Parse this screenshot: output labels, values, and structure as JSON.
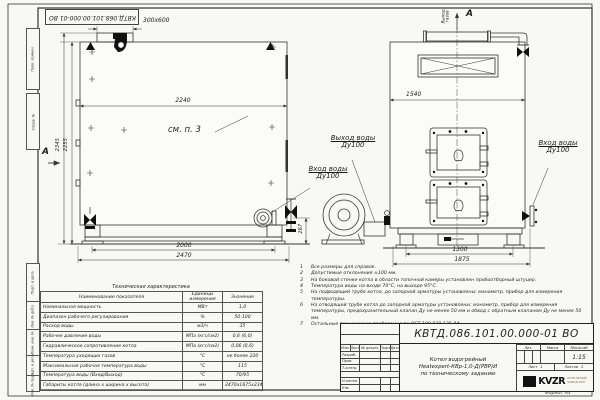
{
  "frame": {
    "stamp_top": "КВТД.068.101.00.000-01 ВО",
    "side_labels": [
      "Перв. примен.",
      "Справ. №",
      "Подп. и дата",
      "Инв. № дубл.",
      "Взам. инв. №",
      "Подп. и дата",
      "Инв. № подл."
    ],
    "format_note": "Формат А3"
  },
  "dims": {
    "duct": "300x600",
    "side_width": "2240",
    "side_height_total": "2345",
    "side_height_body": "2255",
    "side_base_inner": "2000",
    "side_base_outer": "2470",
    "inlet_height": "267",
    "front_width": "1540",
    "front_base_inner": "1300",
    "front_base_outer": "1875"
  },
  "labels": {
    "see_note": "см. п. 3",
    "view_arrow_left": "А",
    "view_arrow_top": "А",
    "water_out_line1": "Выход воды",
    "water_out_line2": "Ду100",
    "water_in_line1": "Вход воды",
    "water_in_line2": "Ду100",
    "gas_out_line1": "Выход",
    "gas_out_line2": "газов",
    "water_in_right_line1": "Вход воды",
    "water_in_right_line2": "Ду100"
  },
  "notes": [
    {
      "n": "1",
      "t": "Все размеры для справок."
    },
    {
      "n": "2",
      "t": "Допустимые отклонения ±100 мм."
    },
    {
      "n": "3",
      "t": "На боковой стенке котла в области топочной камеры установлен пробоотборный штуцер."
    },
    {
      "n": "4",
      "t": "Температура воды на входе 70°С, на выходе 95°С."
    },
    {
      "n": "5",
      "t": "На подводящей трубе котла, до запорной арматуры установлены: манометр, прибор для измерения температуры."
    },
    {
      "n": "6",
      "t": "На отводящей трубе котла до запорной арматуры установлены: манометр, прибор для измерения температуры, предохранительный клапан Ду не менее 50 мм и обвод с обратным клапаном Ду не менее 50 мм."
    },
    {
      "n": "7",
      "t": "Остальные технические требования по ОСТ 108.030.135-84."
    }
  ],
  "tech_table": {
    "title": "Техническая характеристика",
    "headers": [
      "Наименование показателя",
      "Единицы измерения",
      "Значение"
    ],
    "rows": [
      [
        "Номинальная мощность",
        "МВт",
        "1,0"
      ],
      [
        "Диапазон рабочего регулирования",
        "%",
        "50-100"
      ],
      [
        "Расход воды",
        "м3/ч",
        "35"
      ],
      [
        "Рабочее давление воды",
        "МПа (кгс/см2)",
        "0,6 (6,0)"
      ],
      [
        "Гидравлическое сопротивление котла",
        "МПа (кгс/см2)",
        "0,06 (0,6)"
      ],
      [
        "Температура уходящих газов",
        "°С",
        "не более 220"
      ],
      [
        "Максимальная рабочая температура воды",
        "°С",
        "115"
      ],
      [
        "Температура воды (Вход/Выход)",
        "°С",
        "70/95"
      ],
      [
        "Габариты котла (длина х ширина х высота)",
        "мм",
        "2470х1875х2345"
      ]
    ]
  },
  "title_block": {
    "doc_number": "КВТД.086.101.00.000-01 ВО",
    "title_line1": "Котел водогрейный",
    "title_line2": "Heatexpert-КВр-1,0-Д(РВР)И",
    "title_line3": "по техническому заданию",
    "col_headers": [
      "Изм.",
      "Лист",
      "№ докум.",
      "Подп.",
      "Дата"
    ],
    "row_labels": [
      "Разраб.",
      "Пров.",
      "Т.контр.",
      "Н.контр.",
      "Утв."
    ],
    "lit_header": "Лит.",
    "mass_header": "Масса",
    "scale_header": "Масштаб",
    "scale_value": "1:15",
    "sheet_label": "Лист",
    "sheet_value": "1",
    "sheets_label": "Листов",
    "sheets_value": "2",
    "logo_text": "KVZR",
    "logo_sub1": "КОТЕЛЬНЫЙ",
    "logo_sub2": "ЗАВОД РЭП"
  },
  "colors": {
    "line": "#333333",
    "paper": "#f8f8f4",
    "fill_dark": "#111111"
  }
}
